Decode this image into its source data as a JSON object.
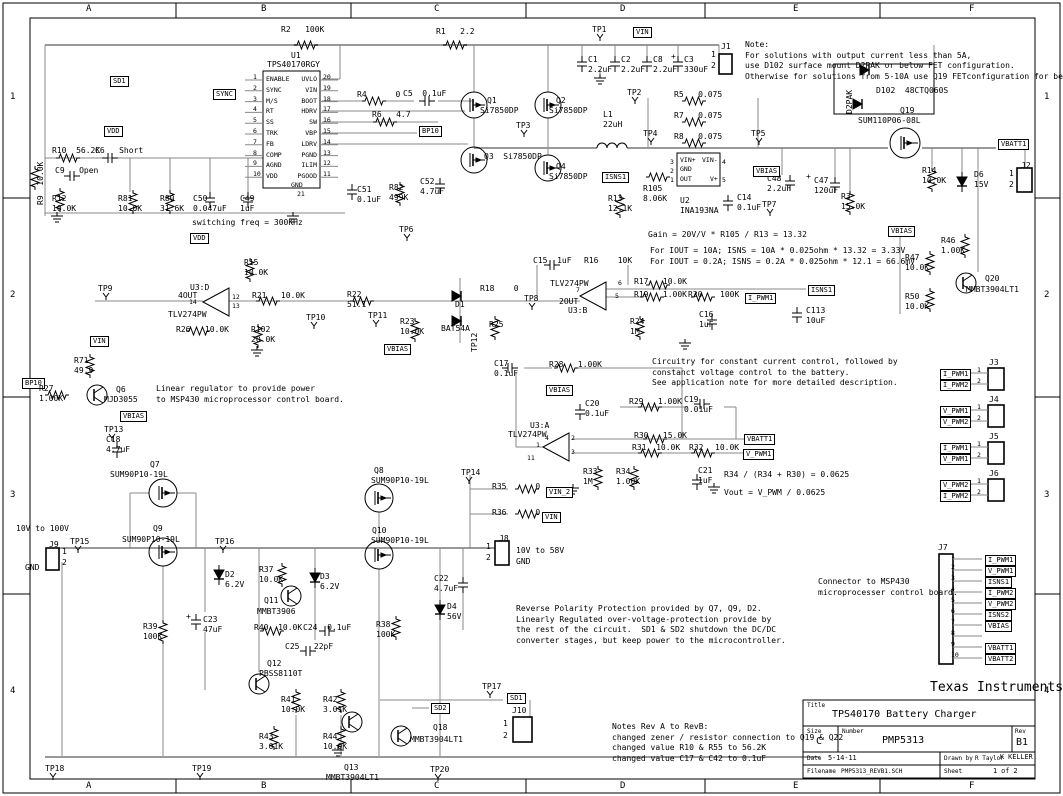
{
  "frame": {
    "cols": [
      "A",
      "B",
      "C",
      "D",
      "E",
      "F"
    ],
    "rows": [
      "1",
      "2",
      "3",
      "4"
    ]
  },
  "title_block": {
    "company": "Texas Instruments",
    "title_label": "Title",
    "title": "TPS40170 Battery Charger",
    "size_label": "Size",
    "size": "C",
    "number_label": "Number",
    "number": "PMP5313",
    "rev_label": "Rev",
    "rev": "B1",
    "date_label": "Date",
    "date": "5-14-11",
    "drawn_label": "Drawn by",
    "drawn_by": "R Taylor",
    "checked_by": "K KELLER",
    "filename_label": "Filename",
    "filename": "PMP5313_REVB1.SCH",
    "sheet_label": "Sheet",
    "sheet": "1 of 2"
  },
  "u1": {
    "ref": "U1",
    "part": "TPS40170RGY",
    "left_pins": [
      "ENABLE",
      "SYNC",
      "M/S",
      "RT",
      "SS",
      "TRK",
      "FB",
      "COMP",
      "AGND",
      "VDD"
    ],
    "left_nums": [
      "1",
      "2",
      "3",
      "4",
      "5",
      "6",
      "7",
      "8",
      "9",
      "10"
    ],
    "right_pins": [
      "UVLO",
      "VIN",
      "BOOT",
      "HDRV",
      "SW",
      "VBP",
      "LDRV",
      "PGND",
      "ILIM",
      "PGOOD"
    ],
    "right_nums": [
      "20",
      "19",
      "18",
      "17",
      "16",
      "15",
      "14",
      "13",
      "12",
      "11"
    ],
    "gnd": "GND",
    "gnd_pin": "21"
  },
  "j7": {
    "ref": "J7",
    "pins": [
      "1",
      "2",
      "3",
      "4",
      "5",
      "6",
      "7",
      "8",
      "9",
      "10"
    ],
    "flags": [
      "I_PWM1",
      "V_PWM1",
      "ISNS1",
      "I_PWM2",
      "V_PWM2",
      "ISNS2",
      "VBIAS",
      "",
      "VBATT1",
      "VBATT2"
    ],
    "note": "Connector to MSP430\nmicroprocesser control board."
  },
  "jconn": [
    {
      "ref": "J3",
      "pins": [
        "1",
        "2"
      ],
      "flags": [
        "I_PWM1",
        "I_PWM2"
      ]
    },
    {
      "ref": "J4",
      "pins": [
        "1",
        "2"
      ],
      "flags": [
        "V_PWM1",
        "V_PWM2"
      ]
    },
    {
      "ref": "J5",
      "pins": [
        "1",
        "2"
      ],
      "flags": [
        "I_PWM1",
        "V_PWM1"
      ]
    },
    {
      "ref": "J6",
      "pins": [
        "1",
        "2"
      ],
      "flags": [
        "V_PWM2",
        "I_PWM2"
      ]
    }
  ],
  "labels": [
    {
      "t": "R2   100K",
      "x": 281,
      "y": 25
    },
    {
      "t": "R1   2.2",
      "x": 436,
      "y": 27
    },
    {
      "t": "TP1",
      "x": 592,
      "y": 25,
      "c": "tp"
    },
    {
      "t": "VIN",
      "x": 633,
      "y": 27,
      "c": "f"
    },
    {
      "t": "J1",
      "x": 721,
      "y": 42
    },
    {
      "t": "1",
      "x": 711,
      "y": 50
    },
    {
      "t": "2",
      "x": 711,
      "y": 61
    },
    {
      "t": "C1\n2.2uF",
      "x": 588,
      "y": 55
    },
    {
      "t": "C2\n2.2uF",
      "x": 621,
      "y": 55
    },
    {
      "t": "C8\n2.2uF",
      "x": 653,
      "y": 55
    },
    {
      "t": "+",
      "x": 671,
      "y": 52
    },
    {
      "t": "C3\n330uF",
      "x": 684,
      "y": 55
    },
    {
      "t": "Note:\nFor solutions with output current less than 5A,\nuse D102 surface mount D2PAK or below FET configuration.\nOtherwise for solutions from 5-10A use Q19 FETconfiguration for better efficiency.",
      "x": 745,
      "y": 40,
      "c": "n"
    },
    {
      "t": "TP2",
      "x": 627,
      "y": 88,
      "c": "tp"
    },
    {
      "t": "SD1",
      "x": 110,
      "y": 76,
      "c": "f"
    },
    {
      "t": "SYNC",
      "x": 213,
      "y": 89,
      "c": "f"
    },
    {
      "t": "VDD",
      "x": 104,
      "y": 126,
      "c": "f"
    },
    {
      "t": "R4      0",
      "x": 357,
      "y": 90
    },
    {
      "t": "C5  0.1uF",
      "x": 403,
      "y": 89
    },
    {
      "t": "R6   4.7",
      "x": 372,
      "y": 110
    },
    {
      "t": "BP10",
      "x": 419,
      "y": 126,
      "c": "f"
    },
    {
      "t": "Q1",
      "x": 487,
      "y": 96
    },
    {
      "t": "Si7850DP",
      "x": 480,
      "y": 106
    },
    {
      "t": "Q2",
      "x": 556,
      "y": 96
    },
    {
      "t": "Si7850DP",
      "x": 549,
      "y": 106
    },
    {
      "t": "Q3  Si7850DP",
      "x": 484,
      "y": 152
    },
    {
      "t": "Q4",
      "x": 556,
      "y": 162
    },
    {
      "t": "Si7850DP",
      "x": 549,
      "y": 172
    },
    {
      "t": "TP3",
      "x": 516,
      "y": 121,
      "c": "tp"
    },
    {
      "t": "L1\n22uH",
      "x": 603,
      "y": 110
    },
    {
      "t": "TP4",
      "x": 643,
      "y": 129,
      "c": "tp"
    },
    {
      "t": "R5   0.075",
      "x": 674,
      "y": 90
    },
    {
      "t": "R7   0.075",
      "x": 674,
      "y": 111
    },
    {
      "t": "R8   0.075",
      "x": 674,
      "y": 132
    },
    {
      "t": "TP5",
      "x": 751,
      "y": 129,
      "c": "tp"
    },
    {
      "t": "D2PAK",
      "x": 845,
      "y": 114,
      "c": "r"
    },
    {
      "t": "D102  48CTQ060S",
      "x": 876,
      "y": 86
    },
    {
      "t": "Q19",
      "x": 900,
      "y": 106
    },
    {
      "t": "SUM110P06-08L",
      "x": 858,
      "y": 116
    },
    {
      "t": "VBATT1",
      "x": 998,
      "y": 139,
      "c": "f"
    },
    {
      "t": "J2",
      "x": 1021,
      "y": 161
    },
    {
      "t": "1",
      "x": 1009,
      "y": 169
    },
    {
      "t": "2",
      "x": 1009,
      "y": 180
    },
    {
      "t": "R14\n10.0K",
      "x": 922,
      "y": 166
    },
    {
      "t": "D6\n15V",
      "x": 974,
      "y": 170
    },
    {
      "t": "C48\n2.2uF",
      "x": 767,
      "y": 174
    },
    {
      "t": "+",
      "x": 806,
      "y": 172
    },
    {
      "t": "C47\n120uF",
      "x": 814,
      "y": 176
    },
    {
      "t": "R3\n15.0K",
      "x": 841,
      "y": 192
    },
    {
      "t": "VBIAS",
      "x": 753,
      "y": 166,
      "c": "f"
    },
    {
      "t": "ISNS1",
      "x": 602,
      "y": 172,
      "c": "f"
    },
    {
      "t": "R105\n8.06K",
      "x": 643,
      "y": 184
    },
    {
      "t": "R13\n12.1K",
      "x": 608,
      "y": 194
    },
    {
      "t": "U2\nINA193NA",
      "x": 680,
      "y": 196
    },
    {
      "t": "VIN+",
      "x": 680,
      "y": 157,
      "c": "s"
    },
    {
      "t": "VIN-",
      "x": 702,
      "y": 157,
      "c": "s"
    },
    {
      "t": "GND",
      "x": 680,
      "y": 166,
      "c": "s"
    },
    {
      "t": "OUT",
      "x": 680,
      "y": 176,
      "c": "s"
    },
    {
      "t": "V+",
      "x": 710,
      "y": 176,
      "c": "s"
    },
    {
      "t": "3",
      "x": 670,
      "y": 159,
      "c": "s"
    },
    {
      "t": "2",
      "x": 670,
      "y": 168,
      "c": "s"
    },
    {
      "t": "1",
      "x": 670,
      "y": 177,
      "c": "s"
    },
    {
      "t": "4",
      "x": 722,
      "y": 159,
      "c": "s"
    },
    {
      "t": "5",
      "x": 722,
      "y": 177,
      "c": "s"
    },
    {
      "t": "C14\n0.1uF",
      "x": 737,
      "y": 193
    },
    {
      "t": "TP7",
      "x": 762,
      "y": 200,
      "c": "tp"
    },
    {
      "t": "Gain = 20V/V * R105 / R13 = 13.32",
      "x": 648,
      "y": 230,
      "c": "n"
    },
    {
      "t": "For IOUT = 10A; ISNS = 10A * 0.025ohm * 13.32 = 3.33V\nFor IOUT = 0.2A; ISNS = 0.2A * 0.025ohm * 12.1 = 66.6mV",
      "x": 650,
      "y": 246,
      "c": "n"
    },
    {
      "t": "switching freq = 300KHz",
      "x": 192,
      "y": 218,
      "c": "n"
    },
    {
      "t": "TP6",
      "x": 399,
      "y": 225,
      "c": "tp"
    },
    {
      "t": "C51\n0.1uF",
      "x": 357,
      "y": 185
    },
    {
      "t": "R82\n499K",
      "x": 389,
      "y": 183
    },
    {
      "t": "C52\n4.7uF",
      "x": 420,
      "y": 177
    },
    {
      "t": "C50\n0.047uF",
      "x": 193,
      "y": 194
    },
    {
      "t": "C49\n1uF",
      "x": 240,
      "y": 194
    },
    {
      "t": "R80\n31.6K",
      "x": 160,
      "y": 194
    },
    {
      "t": "R81\n10.0K",
      "x": 118,
      "y": 194
    },
    {
      "t": "R12\n10.0K",
      "x": 52,
      "y": 194
    },
    {
      "t": "R10  56.2K",
      "x": 52,
      "y": 146
    },
    {
      "t": "C6   Short",
      "x": 95,
      "y": 146
    },
    {
      "t": "C9   Open",
      "x": 55,
      "y": 166
    },
    {
      "t": "R9  10.0K",
      "x": 36,
      "y": 205,
      "c": "r"
    },
    {
      "t": "VDD",
      "x": 190,
      "y": 233,
      "c": "f"
    },
    {
      "t": "GND",
      "x": 291,
      "y": 182,
      "c": "s"
    },
    {
      "t": "21",
      "x": 297,
      "y": 191,
      "c": "s"
    },
    {
      "t": "R15\n10.0K",
      "x": 244,
      "y": 258
    },
    {
      "t": "TP9",
      "x": 98,
      "y": 284,
      "c": "tp"
    },
    {
      "t": "U3:D",
      "x": 190,
      "y": 283
    },
    {
      "t": "4OUT",
      "x": 178,
      "y": 291
    },
    {
      "t": "14",
      "x": 189,
      "y": 299,
      "c": "s"
    },
    {
      "t": "TLV274PW",
      "x": 168,
      "y": 310
    },
    {
      "t": "12",
      "x": 232,
      "y": 294,
      "c": "s"
    },
    {
      "t": "13",
      "x": 232,
      "y": 303,
      "c": "s"
    },
    {
      "t": "R21   10.0K",
      "x": 252,
      "y": 291
    },
    {
      "t": "R26   10.0K",
      "x": 176,
      "y": 325
    },
    {
      "t": "R102\n20.0K",
      "x": 251,
      "y": 325
    },
    {
      "t": "R22\n51.1",
      "x": 347,
      "y": 290
    },
    {
      "t": "TP10",
      "x": 306,
      "y": 313,
      "c": "tp"
    },
    {
      "t": "TP11",
      "x": 368,
      "y": 311,
      "c": "tp"
    },
    {
      "t": "R23\n10.0K",
      "x": 400,
      "y": 317
    },
    {
      "t": "VBIAS",
      "x": 384,
      "y": 344,
      "c": "f"
    },
    {
      "t": "D1",
      "x": 455,
      "y": 300
    },
    {
      "t": "BAT54A",
      "x": 441,
      "y": 324
    },
    {
      "t": "R18    0",
      "x": 480,
      "y": 284
    },
    {
      "t": "R25",
      "x": 489,
      "y": 320
    },
    {
      "t": "TP12",
      "x": 470,
      "y": 352,
      "c": "r"
    },
    {
      "t": "C15  1uF",
      "x": 533,
      "y": 256
    },
    {
      "t": "R16    10K",
      "x": 584,
      "y": 256
    },
    {
      "t": "TLV274PW",
      "x": 550,
      "y": 279
    },
    {
      "t": "7",
      "x": 576,
      "y": 287,
      "c": "s"
    },
    {
      "t": "2OUT",
      "x": 559,
      "y": 297
    },
    {
      "t": "U3:B",
      "x": 568,
      "y": 306
    },
    {
      "t": "6",
      "x": 618,
      "y": 280,
      "c": "s"
    },
    {
      "t": "5",
      "x": 615,
      "y": 293,
      "c": "s"
    },
    {
      "t": "TP8",
      "x": 524,
      "y": 294,
      "c": "tp"
    },
    {
      "t": "R17   10.0K",
      "x": 634,
      "y": 277
    },
    {
      "t": "R19   1.00K",
      "x": 634,
      "y": 290
    },
    {
      "t": "R20",
      "x": 688,
      "y": 290
    },
    {
      "t": "100K",
      "x": 720,
      "y": 290
    },
    {
      "t": "I_PWM1",
      "x": 745,
      "y": 293,
      "c": "f"
    },
    {
      "t": "ISNS1",
      "x": 808,
      "y": 285,
      "c": "f"
    },
    {
      "t": "R24\n1M",
      "x": 630,
      "y": 317
    },
    {
      "t": "C16\n1uF",
      "x": 699,
      "y": 310
    },
    {
      "t": "C113\n10uF",
      "x": 806,
      "y": 306
    },
    {
      "t": "VBIAS",
      "x": 888,
      "y": 226,
      "c": "f"
    },
    {
      "t": "R46\n1.00K",
      "x": 941,
      "y": 236
    },
    {
      "t": "R47\n10.0K",
      "x": 905,
      "y": 253
    },
    {
      "t": "R50\n10.0K",
      "x": 905,
      "y": 292
    },
    {
      "t": "Q20",
      "x": 985,
      "y": 274
    },
    {
      "t": "MMBT3904LT1",
      "x": 966,
      "y": 285
    },
    {
      "t": "VIN",
      "x": 90,
      "y": 336,
      "c": "f"
    },
    {
      "t": "R71\n49.9",
      "x": 74,
      "y": 356
    },
    {
      "t": "BP10",
      "x": 22,
      "y": 378,
      "c": "f"
    },
    {
      "t": "R27\n1.00K",
      "x": 39,
      "y": 384
    },
    {
      "t": "Q6",
      "x": 116,
      "y": 385
    },
    {
      "t": "MJD3055",
      "x": 104,
      "y": 395
    },
    {
      "t": "Linear regulator to provide power\nto MSP430 microprocessor control board.",
      "x": 156,
      "y": 384,
      "c": "n"
    },
    {
      "t": "VBIAS",
      "x": 120,
      "y": 411,
      "c": "f"
    },
    {
      "t": "TP13",
      "x": 104,
      "y": 425,
      "c": "tp"
    },
    {
      "t": "C18\n4.7uF",
      "x": 106,
      "y": 435
    },
    {
      "t": "C17\n0.1uF",
      "x": 494,
      "y": 359
    },
    {
      "t": "R28   1.00K",
      "x": 549,
      "y": 360
    },
    {
      "t": "VBIAS",
      "x": 546,
      "y": 385,
      "c": "f"
    },
    {
      "t": "C20\n0.1uF",
      "x": 585,
      "y": 399
    },
    {
      "t": "R29   1.00K",
      "x": 629,
      "y": 397
    },
    {
      "t": "C19\n0.01uF",
      "x": 684,
      "y": 395
    },
    {
      "t": "U3:A",
      "x": 530,
      "y": 421
    },
    {
      "t": "TLV274PW",
      "x": 508,
      "y": 430
    },
    {
      "t": "4",
      "x": 545,
      "y": 435,
      "c": "s"
    },
    {
      "t": "2",
      "x": 571,
      "y": 435,
      "c": "s"
    },
    {
      "t": "1",
      "x": 536,
      "y": 442,
      "c": "s"
    },
    {
      "t": "3",
      "x": 571,
      "y": 449,
      "c": "s"
    },
    {
      "t": "11",
      "x": 527,
      "y": 455,
      "c": "s"
    },
    {
      "t": "R30   15.0K",
      "x": 634,
      "y": 431
    },
    {
      "t": "R31  10.0K",
      "x": 632,
      "y": 443
    },
    {
      "t": "R32",
      "x": 689,
      "y": 443
    },
    {
      "t": "10.0K",
      "x": 715,
      "y": 443
    },
    {
      "t": "VBATT1",
      "x": 744,
      "y": 434,
      "c": "f"
    },
    {
      "t": "V_PWM1",
      "x": 743,
      "y": 449,
      "c": "f"
    },
    {
      "t": "R33\n1M",
      "x": 583,
      "y": 467
    },
    {
      "t": "R34\n1.00K",
      "x": 616,
      "y": 467
    },
    {
      "t": "C21\n1uF",
      "x": 698,
      "y": 466
    },
    {
      "t": "R34 / (R34 + R30) = 0.0625",
      "x": 724,
      "y": 470,
      "c": "n"
    },
    {
      "t": "Vout = V_PWM / 0.0625",
      "x": 724,
      "y": 488,
      "c": "n"
    },
    {
      "t": "Circuitry for constant current control, followed by\nconstanct voltage control to the battery.\nSee application note for more detailed description.",
      "x": 652,
      "y": 357,
      "c": "n"
    },
    {
      "t": "Q8",
      "x": 374,
      "y": 466
    },
    {
      "t": "SUM90P10-19L",
      "x": 371,
      "y": 476
    },
    {
      "t": "Q10",
      "x": 372,
      "y": 526
    },
    {
      "t": "SUM90P10-19L",
      "x": 371,
      "y": 536
    },
    {
      "t": "TP14",
      "x": 461,
      "y": 468,
      "c": "tp"
    },
    {
      "t": "R35      0",
      "x": 492,
      "y": 482
    },
    {
      "t": "VIN_2",
      "x": 546,
      "y": 487,
      "c": "f"
    },
    {
      "t": "R36      0",
      "x": 492,
      "y": 508
    },
    {
      "t": "VIN",
      "x": 542,
      "y": 512,
      "c": "f"
    },
    {
      "t": "J8",
      "x": 499,
      "y": 534
    },
    {
      "t": "1",
      "x": 486,
      "y": 542
    },
    {
      "t": "2",
      "x": 486,
      "y": 553
    },
    {
      "t": "10V to 58V\nGND",
      "x": 516,
      "y": 546,
      "c": "n"
    },
    {
      "t": "C22\n4.7uF",
      "x": 434,
      "y": 574
    },
    {
      "t": "D4\n56V",
      "x": 447,
      "y": 602
    },
    {
      "t": "R38\n100K",
      "x": 376,
      "y": 620
    },
    {
      "t": "Q7",
      "x": 150,
      "y": 460
    },
    {
      "t": "SUM90P10-19L",
      "x": 110,
      "y": 470
    },
    {
      "t": "Q9",
      "x": 153,
      "y": 524
    },
    {
      "t": "SUM90P10-19L",
      "x": 122,
      "y": 535
    },
    {
      "t": "10V to 100V",
      "x": 16,
      "y": 524,
      "c": "n"
    },
    {
      "t": "J9",
      "x": 49,
      "y": 540
    },
    {
      "t": "1",
      "x": 62,
      "y": 547
    },
    {
      "t": "2",
      "x": 62,
      "y": 558
    },
    {
      "t": "GND",
      "x": 25,
      "y": 563,
      "c": "n"
    },
    {
      "t": "TP15",
      "x": 70,
      "y": 537,
      "c": "tp"
    },
    {
      "t": "TP16",
      "x": 215,
      "y": 537,
      "c": "tp"
    },
    {
      "t": "D2\n6.2V",
      "x": 225,
      "y": 570
    },
    {
      "t": "R39\n100K",
      "x": 143,
      "y": 622
    },
    {
      "t": "+",
      "x": 186,
      "y": 612
    },
    {
      "t": "C23\n47uF",
      "x": 203,
      "y": 615
    },
    {
      "t": "R37\n10.0K",
      "x": 259,
      "y": 565
    },
    {
      "t": "Q11",
      "x": 264,
      "y": 596
    },
    {
      "t": "MMBT3906",
      "x": 257,
      "y": 607
    },
    {
      "t": "D3\n6.2V",
      "x": 320,
      "y": 572
    },
    {
      "t": "R40  10.0K",
      "x": 254,
      "y": 623
    },
    {
      "t": "C24  0.1uF",
      "x": 303,
      "y": 623
    },
    {
      "t": "C25   22pF",
      "x": 285,
      "y": 642
    },
    {
      "t": "Q12",
      "x": 267,
      "y": 659
    },
    {
      "t": "PBSS8110T",
      "x": 259,
      "y": 669
    },
    {
      "t": "R41\n10.0K",
      "x": 281,
      "y": 695
    },
    {
      "t": "R42\n3.01K",
      "x": 323,
      "y": 695
    },
    {
      "t": "R43\n3.01K",
      "x": 259,
      "y": 732
    },
    {
      "t": "R44\n10.0K",
      "x": 323,
      "y": 732
    },
    {
      "t": "Q13",
      "x": 344,
      "y": 763
    },
    {
      "t": "MMBT3904LT1",
      "x": 326,
      "y": 773
    },
    {
      "t": "Q18",
      "x": 433,
      "y": 723
    },
    {
      "t": "MMBT3904LT1",
      "x": 410,
      "y": 735
    },
    {
      "t": "SD2",
      "x": 431,
      "y": 703,
      "c": "f"
    },
    {
      "t": "SD1",
      "x": 507,
      "y": 693,
      "c": "f"
    },
    {
      "t": "TP17",
      "x": 482,
      "y": 682,
      "c": "tp"
    },
    {
      "t": "J10",
      "x": 512,
      "y": 706
    },
    {
      "t": "1",
      "x": 503,
      "y": 719
    },
    {
      "t": "2",
      "x": 503,
      "y": 731
    },
    {
      "t": "TP20",
      "x": 430,
      "y": 765,
      "c": "tp"
    },
    {
      "t": "TP18",
      "x": 45,
      "y": 764,
      "c": "tp"
    },
    {
      "t": "TP19",
      "x": 192,
      "y": 764,
      "c": "tp"
    },
    {
      "t": "Reverse Polarity Protection provided by Q7, Q9, D2.\nLinearly Regulated over-voltage-protection provide by\nthe rest of the circuit.  SD1 & SD2 shutdown the DC/DC\nconverter stages, but keep power to the microcontroller.",
      "x": 516,
      "y": 604,
      "c": "n"
    },
    {
      "t": "Notes Rev A to RevB:\nchanged zener / resistor connection to Q19 & Q22\nchanged value R10 & R55 to 56.2K\nchanged value C17 & C42 to 0.1uF",
      "x": 612,
      "y": 722,
      "c": "n"
    }
  ]
}
